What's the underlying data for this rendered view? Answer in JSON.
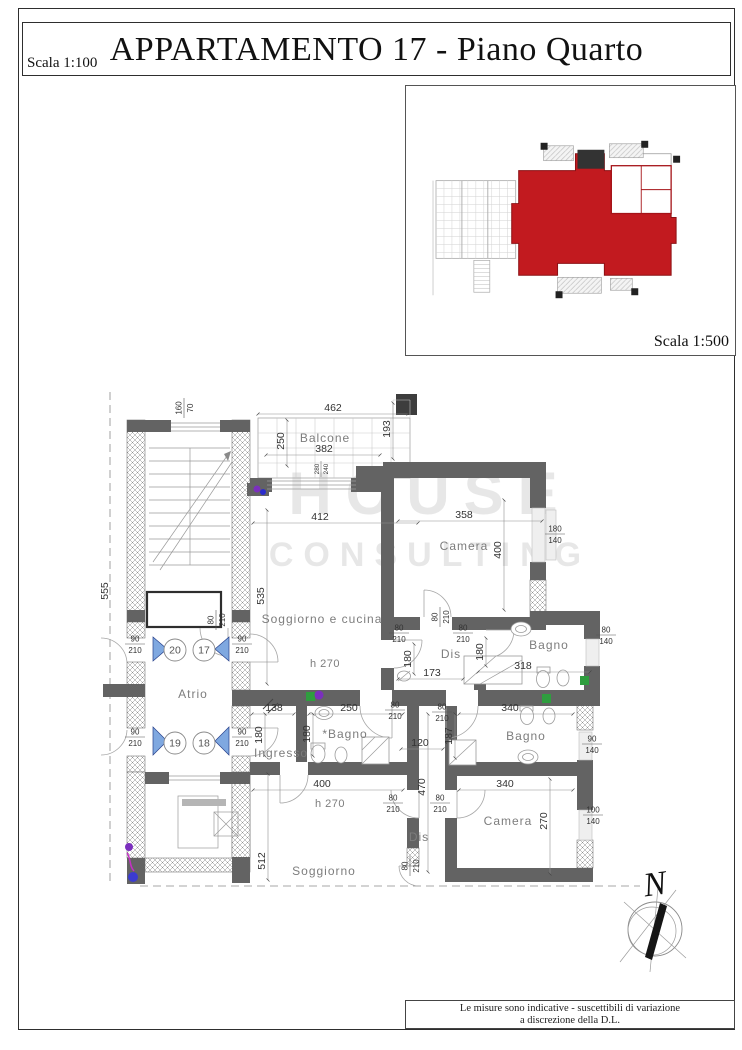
{
  "page": {
    "title": "APPARTAMENTO 17 - Piano Quarto",
    "scale_main": "Scala 1:100",
    "scale_inset": "Scala 1:500",
    "note_line1": "Le misure sono indicative - suscettibili di variazione",
    "note_line2": "a discrezione della D.L.",
    "north_label": "N",
    "watermark_line1": "HOUSE",
    "watermark_line2": "CONSULTING"
  },
  "colors": {
    "wall": "#636363",
    "inset_red": "#c21a1f",
    "door_blue": "#7fa8e0",
    "marker_green": "#2f9e3f",
    "marker_purple": "#7b2fbe"
  },
  "plan": {
    "labels": [
      {
        "t": "room",
        "s": "Balcone",
        "x": 325,
        "y": 442
      },
      {
        "t": "room",
        "s": "Camera",
        "x": 464,
        "y": 550
      },
      {
        "t": "room",
        "s": "Soggiorno e cucina",
        "x": 322,
        "y": 623
      },
      {
        "t": "room",
        "s": "Atrio",
        "x": 193,
        "y": 698
      },
      {
        "t": "room",
        "s": "Bagno",
        "x": 549,
        "y": 649
      },
      {
        "t": "room",
        "s": "Dis",
        "x": 451,
        "y": 658
      },
      {
        "t": "room",
        "s": "*Bagno",
        "x": 345,
        "y": 738
      },
      {
        "t": "room",
        "s": "Ingresso",
        "x": 281,
        "y": 757
      },
      {
        "t": "room",
        "s": "Bagno",
        "x": 526,
        "y": 740
      },
      {
        "t": "room",
        "s": "Dis",
        "x": 419,
        "y": 841
      },
      {
        "t": "room",
        "s": "Camera",
        "x": 508,
        "y": 825
      },
      {
        "t": "room",
        "s": "Soggiorno",
        "x": 324,
        "y": 875
      },
      {
        "t": "rs",
        "s": "h 270",
        "x": 325,
        "y": 667
      },
      {
        "t": "rs",
        "s": "h 270",
        "x": 330,
        "y": 807
      },
      {
        "t": "dim",
        "s": "462",
        "x": 333,
        "y": 411
      },
      {
        "t": "dim",
        "s": "250",
        "x": 284,
        "y": 441,
        "r": -90
      },
      {
        "t": "dim",
        "s": "382",
        "x": 324,
        "y": 452
      },
      {
        "t": "dim",
        "s": "193",
        "x": 390,
        "y": 429,
        "r": -90
      },
      {
        "t": "dim",
        "s": "412",
        "x": 320,
        "y": 520
      },
      {
        "t": "dim",
        "s": "358",
        "x": 464,
        "y": 518
      },
      {
        "t": "dim",
        "s": "400",
        "x": 501,
        "y": 550,
        "r": -90
      },
      {
        "t": "dim",
        "s": "535",
        "x": 264,
        "y": 596,
        "r": -90
      },
      {
        "t": "dim",
        "s": "555",
        "x": 108,
        "y": 591,
        "r": -90
      },
      {
        "t": "dim",
        "s": "138",
        "x": 274,
        "y": 711
      },
      {
        "t": "dim",
        "s": "250",
        "x": 349,
        "y": 711
      },
      {
        "t": "dim",
        "s": "340",
        "x": 510,
        "y": 711
      },
      {
        "t": "dim",
        "s": "173",
        "x": 432,
        "y": 676
      },
      {
        "t": "dim",
        "s": "318",
        "x": 523,
        "y": 669
      },
      {
        "t": "dim",
        "s": "120",
        "x": 420,
        "y": 746
      },
      {
        "t": "dim",
        "s": "180",
        "x": 411,
        "y": 659,
        "r": -90
      },
      {
        "t": "dim",
        "s": "180",
        "x": 483,
        "y": 652,
        "r": -90
      },
      {
        "t": "dim",
        "s": "180",
        "x": 262,
        "y": 735,
        "r": -90
      },
      {
        "t": "dim",
        "s": "180",
        "x": 310,
        "y": 734,
        "r": -90
      },
      {
        "t": "dim",
        "s": "187",
        "x": 452,
        "y": 736,
        "r": -90
      },
      {
        "t": "dim",
        "s": "400",
        "x": 322,
        "y": 787
      },
      {
        "t": "dim",
        "s": "340",
        "x": 505,
        "y": 787
      },
      {
        "t": "dim",
        "s": "470",
        "x": 425,
        "y": 787,
        "r": -90
      },
      {
        "t": "dim",
        "s": "270",
        "x": 547,
        "y": 821,
        "r": -90
      },
      {
        "t": "dim",
        "s": "512",
        "x": 265,
        "y": 861,
        "r": -90
      }
    ],
    "fracs": [
      {
        "a": "160",
        "b": "70",
        "x": 184,
        "y": 408,
        "r": -90
      },
      {
        "a": "280",
        "b": "240",
        "x": 321,
        "y": 469,
        "r": -90,
        "sm": true
      },
      {
        "a": "180",
        "b": "140",
        "x": 555,
        "y": 534
      },
      {
        "a": "80",
        "b": "210",
        "x": 216,
        "y": 620,
        "r": -90
      },
      {
        "a": "90",
        "b": "210",
        "x": 135,
        "y": 644
      },
      {
        "a": "90",
        "b": "210",
        "x": 242,
        "y": 644
      },
      {
        "a": "90",
        "b": "210",
        "x": 135,
        "y": 737
      },
      {
        "a": "90",
        "b": "210",
        "x": 242,
        "y": 737
      },
      {
        "a": "80",
        "b": "210",
        "x": 399,
        "y": 633
      },
      {
        "a": "80",
        "b": "210",
        "x": 463,
        "y": 633
      },
      {
        "a": "80",
        "b": "210",
        "x": 440,
        "y": 617,
        "r": -90
      },
      {
        "a": "80",
        "b": "140",
        "x": 606,
        "y": 635
      },
      {
        "a": "80",
        "b": "210",
        "x": 395,
        "y": 710
      },
      {
        "a": "80",
        "b": "210",
        "x": 442,
        "y": 712
      },
      {
        "a": "90",
        "b": "140",
        "x": 592,
        "y": 744
      },
      {
        "a": "80",
        "b": "210",
        "x": 393,
        "y": 803
      },
      {
        "a": "80",
        "b": "210",
        "x": 440,
        "y": 803
      },
      {
        "a": "100",
        "b": "140",
        "x": 593,
        "y": 815
      },
      {
        "a": "80",
        "b": "210",
        "x": 410,
        "y": 866,
        "r": -90
      }
    ],
    "circles": [
      {
        "n": "20",
        "x": 175,
        "y": 650
      },
      {
        "n": "17",
        "x": 204,
        "y": 650
      },
      {
        "n": "19",
        "x": 175,
        "y": 743
      },
      {
        "n": "18",
        "x": 204,
        "y": 743
      }
    ]
  }
}
